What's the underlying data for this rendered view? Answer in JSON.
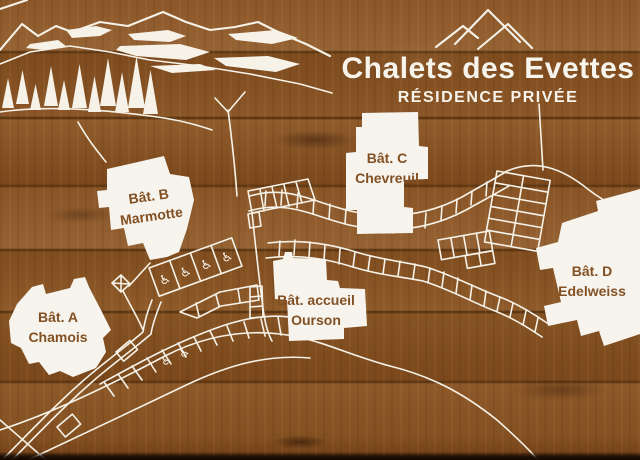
{
  "sign": {
    "title": "Chalets des Evettes",
    "subtitle": "RÉSIDENCE PRIVÉE"
  },
  "buildings": [
    {
      "name": "Bât. A",
      "subname": "Chamois"
    },
    {
      "name": "Bât. B",
      "subname": "Marmotte"
    },
    {
      "name": "Bât. C",
      "subname": "Chevreuil"
    },
    {
      "name": "Bât. accueil",
      "subname": "Ourson"
    },
    {
      "name": "Bât. D",
      "subname": "Edelweiss"
    }
  ],
  "icons": {
    "wheelchair": "♿",
    "logo": "mountain-peaks"
  },
  "colors": {
    "ink_white": "#f6f2e8",
    "label_brown": "#825022",
    "wood_base": "#8a5426"
  }
}
